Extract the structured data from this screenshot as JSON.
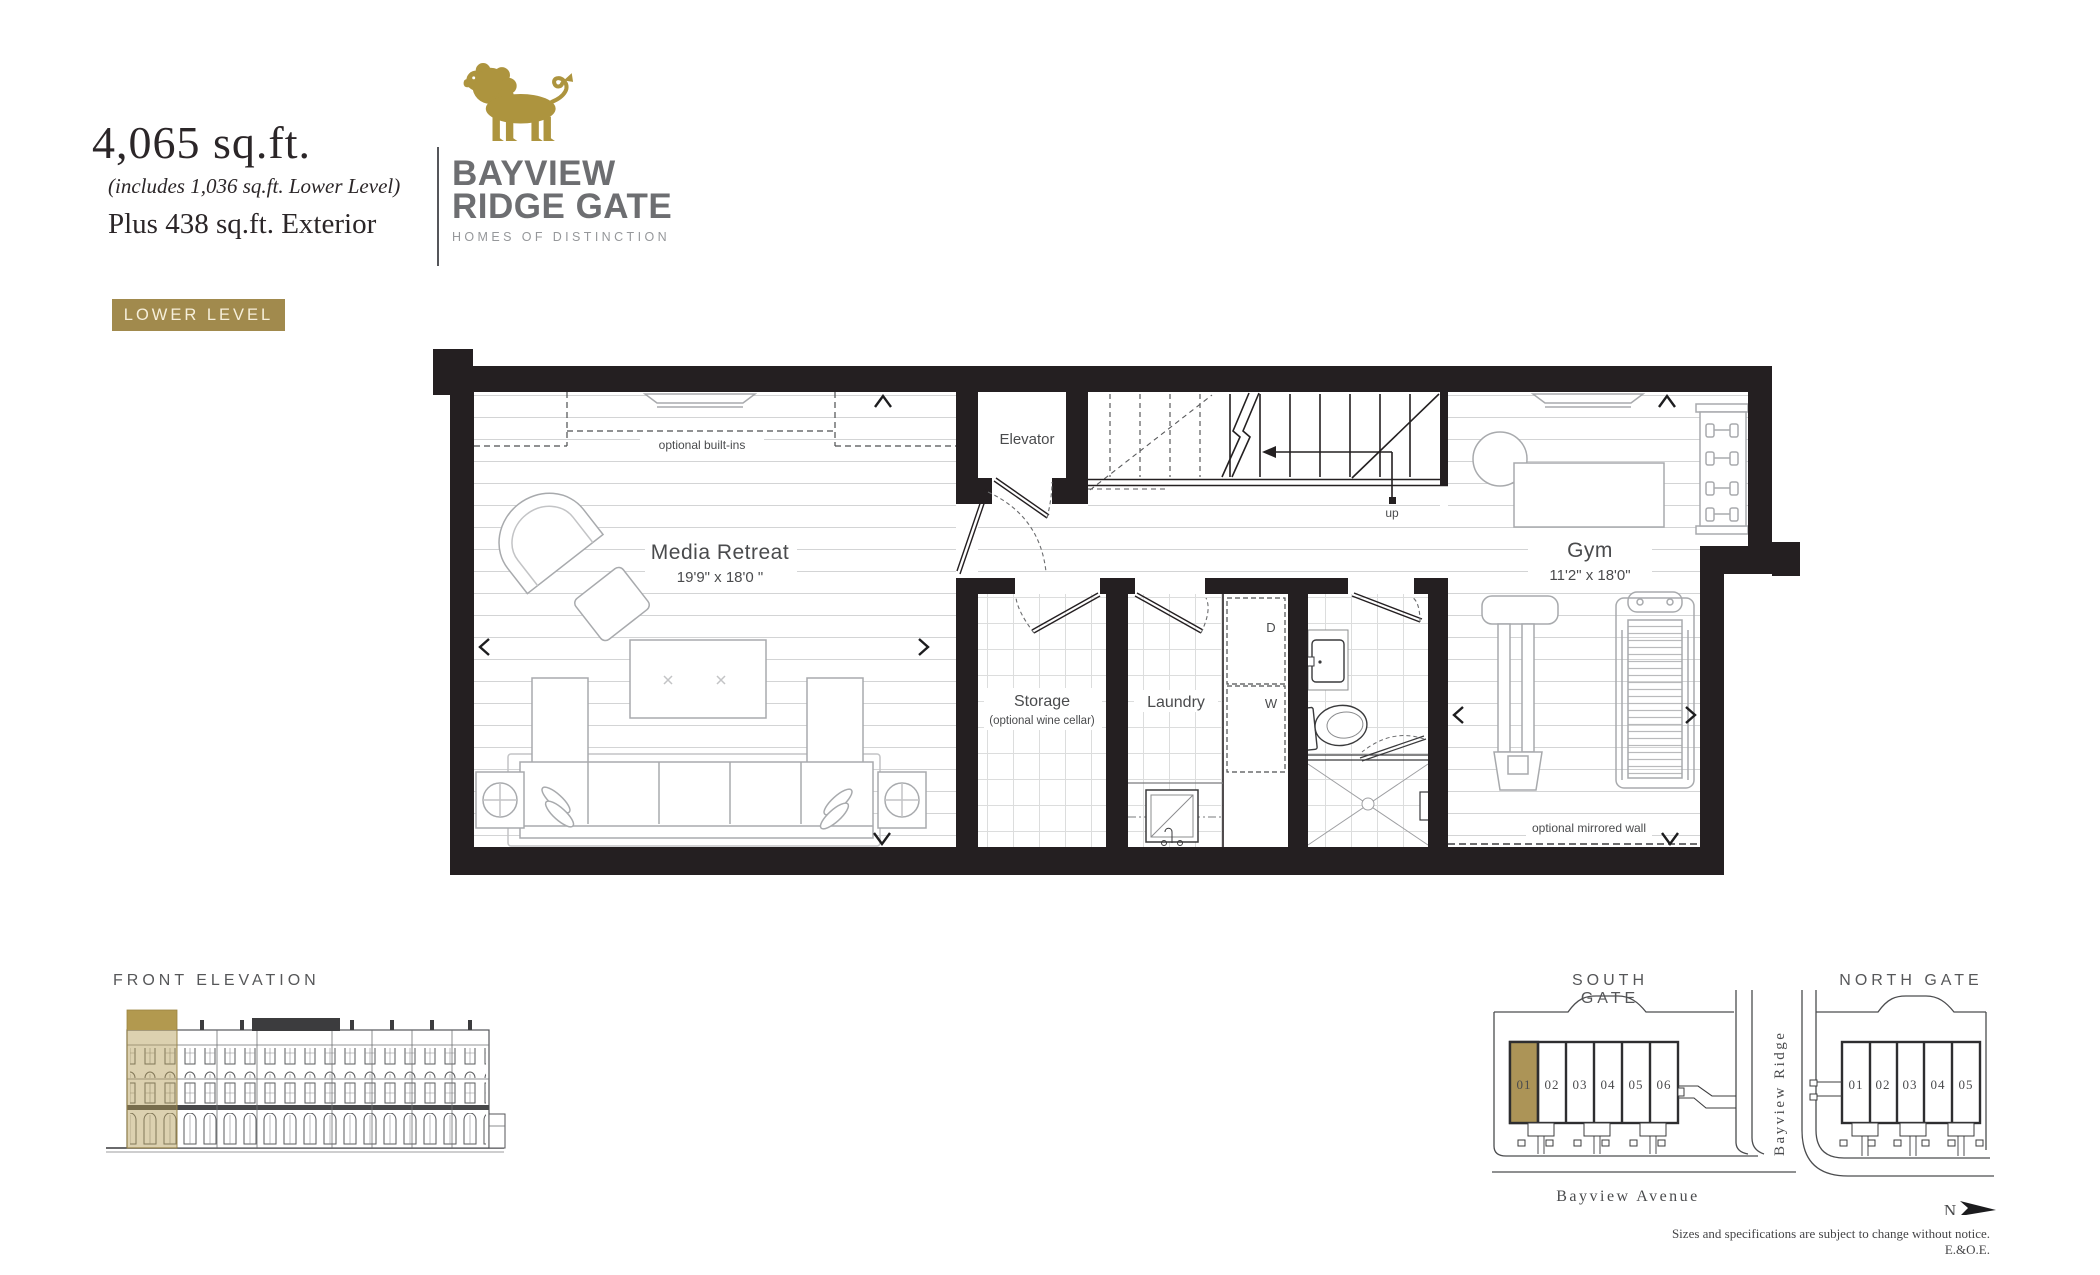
{
  "header": {
    "area": "4,065 sq.ft.",
    "area_note": "(includes 1,036 sq.ft. Lower Level)",
    "exterior": "Plus 438 sq.ft. Exterior"
  },
  "logo": {
    "name_line1": "BAYVIEW",
    "name_line2": "RIDGE GATE",
    "tagline": "HOMES OF DISTINCTION",
    "gold": "#ad943e",
    "gray": "#6d6e71"
  },
  "level_badge": {
    "label": "LOWER LEVEL",
    "bg": "#a18a4d"
  },
  "plan": {
    "media_retreat": {
      "name": "Media Retreat",
      "dims": "19'9\" x 18'0 \""
    },
    "gym": {
      "name": "Gym",
      "dims": "11'2\" x 18'0\""
    },
    "storage": {
      "name": "Storage",
      "note": "(optional wine cellar)"
    },
    "laundry": {
      "name": "Laundry"
    },
    "elevator": {
      "name": "Elevator"
    },
    "up_label": "up",
    "dryer_label": "D",
    "washer_label": "W",
    "optional_builtins": "optional built-ins",
    "optional_mirrored_wall": "optional mirrored wall",
    "wall_color": "#241f21"
  },
  "front_elevation": {
    "title": "FRONT ELEVATION",
    "highlight": "#b29a4f"
  },
  "site": {
    "south": {
      "title": "SOUTH GATE",
      "units": [
        "01",
        "02",
        "03",
        "04",
        "05",
        "06"
      ],
      "highlighted_unit": "01",
      "highlight": "#ac9457"
    },
    "north": {
      "title": "NORTH GATE",
      "units": [
        "01",
        "02",
        "03",
        "04",
        "05"
      ]
    },
    "street_v": "Bayview Ridge",
    "street_h": "Bayview Avenue",
    "north_label": "N"
  },
  "footer": {
    "disclaimer": "Sizes and specifications are subject to change without notice. E.&O.E."
  }
}
